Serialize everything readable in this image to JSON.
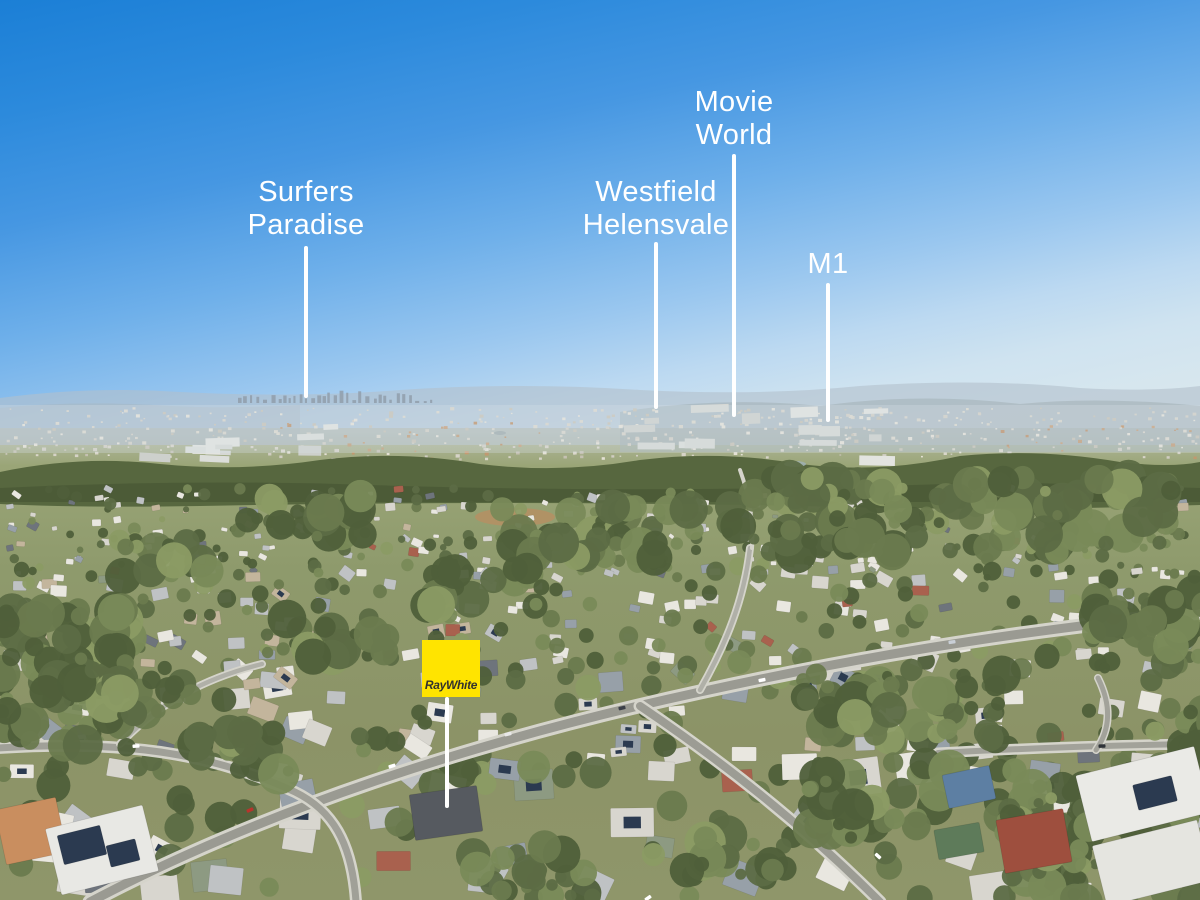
{
  "scene": {
    "type": "aerial-photograph",
    "subject": "suburban estate with distant Gold Coast skyline",
    "sky_top_color": "#1b7fd6",
    "sky_horizon_color": "#d8e7ee",
    "callout_line_color": "#ffffff",
    "callout_text_color": "#ffffff"
  },
  "callouts": [
    {
      "id": "surfers-paradise",
      "lines": [
        "Surfers",
        "Paradise"
      ]
    },
    {
      "id": "westfield-helensvale",
      "lines": [
        "Westfield",
        "Helensvale"
      ]
    },
    {
      "id": "movie-world",
      "lines": [
        "Movie",
        "World"
      ]
    },
    {
      "id": "m1",
      "lines": [
        "M1"
      ]
    }
  ],
  "property_marker": {
    "brand": "RayWhite",
    "bg_color": "#ffe400",
    "text_color": "#32322e"
  }
}
